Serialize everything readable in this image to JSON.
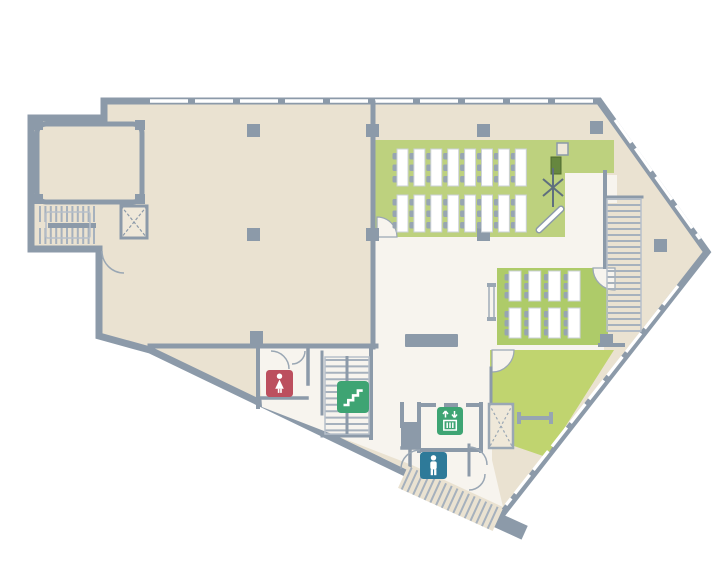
{
  "plan": {
    "title": "building-floor-plan",
    "background": "#ffffff",
    "colors": {
      "beige": "#EAE2D1",
      "floor": "#F7F4EE",
      "wall": "#8C9AA9",
      "wall_light": "#9AA7B4",
      "window": "#FFFFFF",
      "green_classroom": "#BDD17E",
      "green_training": "#AECB69",
      "green_lounge": "#C0D46F",
      "desk": "#FFFFFF",
      "desk_stroke": "#CBD1D8",
      "chair": "#97A5B2",
      "tread": "#A6B1BD",
      "rail": "#B7C0CA",
      "furniture": "#5F6F7E",
      "podium": "#66873F",
      "podium_stroke": "#4E6A2F",
      "shaft": "#EFE8D9",
      "screen": "#FFFFFF",
      "icon_red": "#BC4F5E",
      "icon_blue": "#2E7A99",
      "icon_green": "#3EA473",
      "glyph": "#FFFFFF"
    },
    "rooms": {
      "classroom_large": {
        "desk_rows": 2,
        "desks_per_row": 8,
        "chairs_per_desk": 3
      },
      "classroom_small": {
        "desk_rows": 2,
        "desks_per_row": 4,
        "chairs_per_desk": 3
      }
    },
    "icons": {
      "women_restroom": {
        "name": "women-restroom",
        "color": "#BC4F5E"
      },
      "men_restroom": {
        "name": "men-restroom",
        "color": "#2E7A99"
      },
      "stairs": {
        "name": "stairs",
        "color": "#3EA473"
      },
      "elevator": {
        "name": "elevator",
        "color": "#3EA473"
      }
    }
  }
}
